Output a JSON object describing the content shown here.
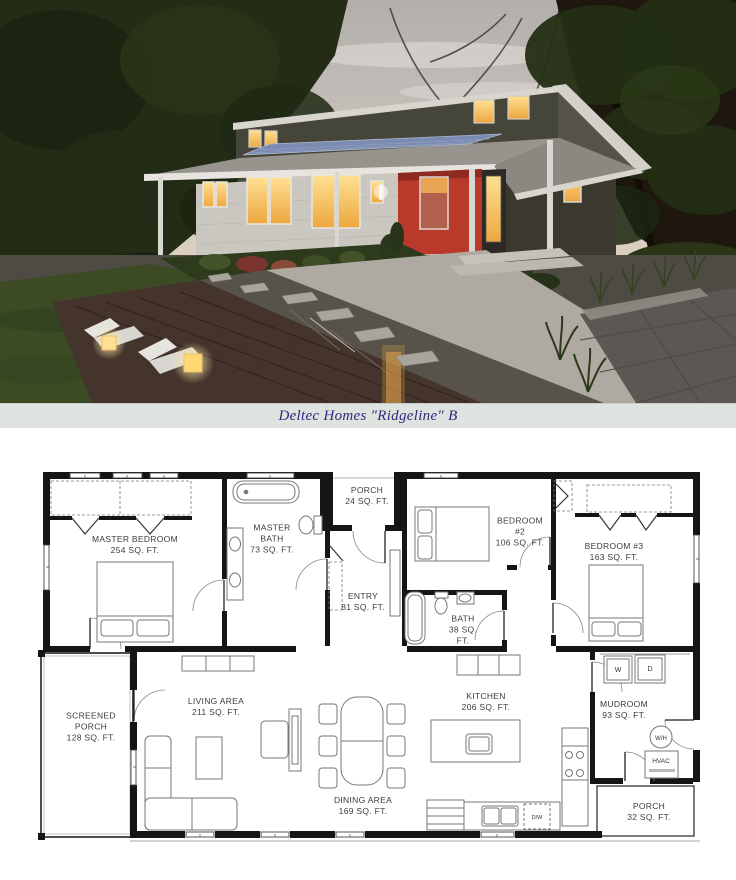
{
  "caption": {
    "text": "Deltec Homes \"Ridgeline\" B"
  },
  "photo": {
    "subject": "modern-house-exterior-dusk-rendering",
    "palette": {
      "sky": "#c2bdb8",
      "sunset_glow": "#f2c795",
      "trees": "#242c16",
      "roof": "#97948d",
      "solar_panel": "#7c8bb2",
      "siding_white": "#c9c7c0",
      "clerestory_dark": "#45453a",
      "accent_red": "#b93a2b",
      "window_glow": "#f6c05e",
      "deck_wood": "#45342c",
      "lawn": "#3d4b25",
      "concrete": "#aeaaa2",
      "patio_tile": "#5b5853"
    }
  },
  "floorplan": {
    "rooms": {
      "master_bedroom": {
        "name": "MASTER BEDROOM",
        "area": "254 SQ. FT."
      },
      "master_bath": {
        "name": "MASTER BATH",
        "area": "73 SQ. FT."
      },
      "porch_front": {
        "name": "PORCH",
        "area": "24 SQ. FT."
      },
      "entry": {
        "name": "ENTRY",
        "area": "81 SQ. FT."
      },
      "bedroom_2": {
        "name": "BEDROOM #2",
        "area": "106 SQ. FT."
      },
      "bedroom_3": {
        "name": "BEDROOM #3",
        "area": "163 SQ. FT."
      },
      "bath": {
        "name": "BATH",
        "area": "38 SQ. FT."
      },
      "screened_porch": {
        "name": "SCREENED PORCH",
        "area": "128 SQ. FT."
      },
      "living_area": {
        "name": "LIVING AREA",
        "area": "211 SQ. FT."
      },
      "dining_area": {
        "name": "DINING AREA",
        "area": "169 SQ. FT."
      },
      "kitchen": {
        "name": "KITCHEN",
        "area": "206 SQ. FT."
      },
      "mudroom": {
        "name": "MUDROOM",
        "area": "93 SQ. FT."
      },
      "porch_rear": {
        "name": "PORCH",
        "area": "32 SQ. FT."
      }
    },
    "labels": {
      "washer": "W",
      "dryer": "D",
      "water_heater": "W/H",
      "hvac": "HVAC",
      "dishwasher": "D/W"
    }
  }
}
